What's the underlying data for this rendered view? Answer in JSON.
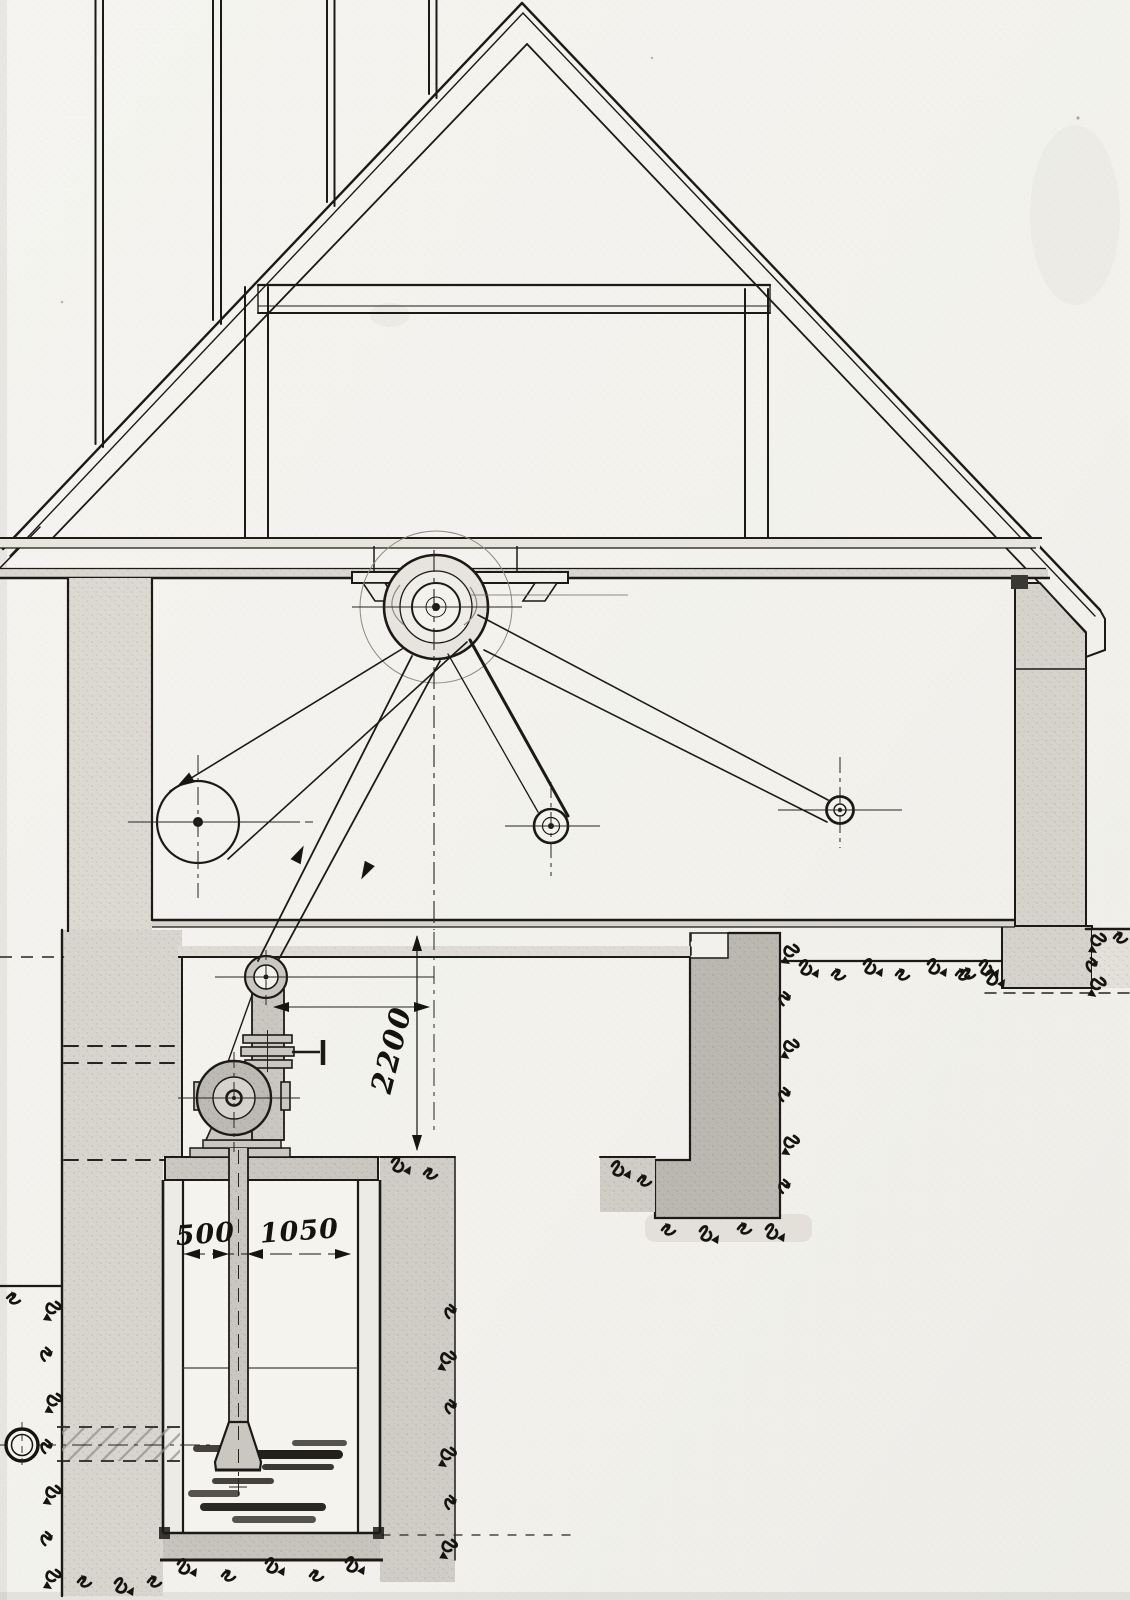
{
  "drawing": {
    "type": "hand-drawn technical cross-section of a pump house with belt drive, pump pit and well",
    "dimension_labels": {
      "pump_drive_height": "2200",
      "well_left_width": "500",
      "well_right_width": "1050"
    },
    "colors": {
      "paper": "#f3f2ee",
      "ink": "#1c1a17",
      "wall_gray": "#d7d5ce",
      "machine_gray": "#c9c7c0",
      "pier_gray": "#bab8b1"
    }
  }
}
